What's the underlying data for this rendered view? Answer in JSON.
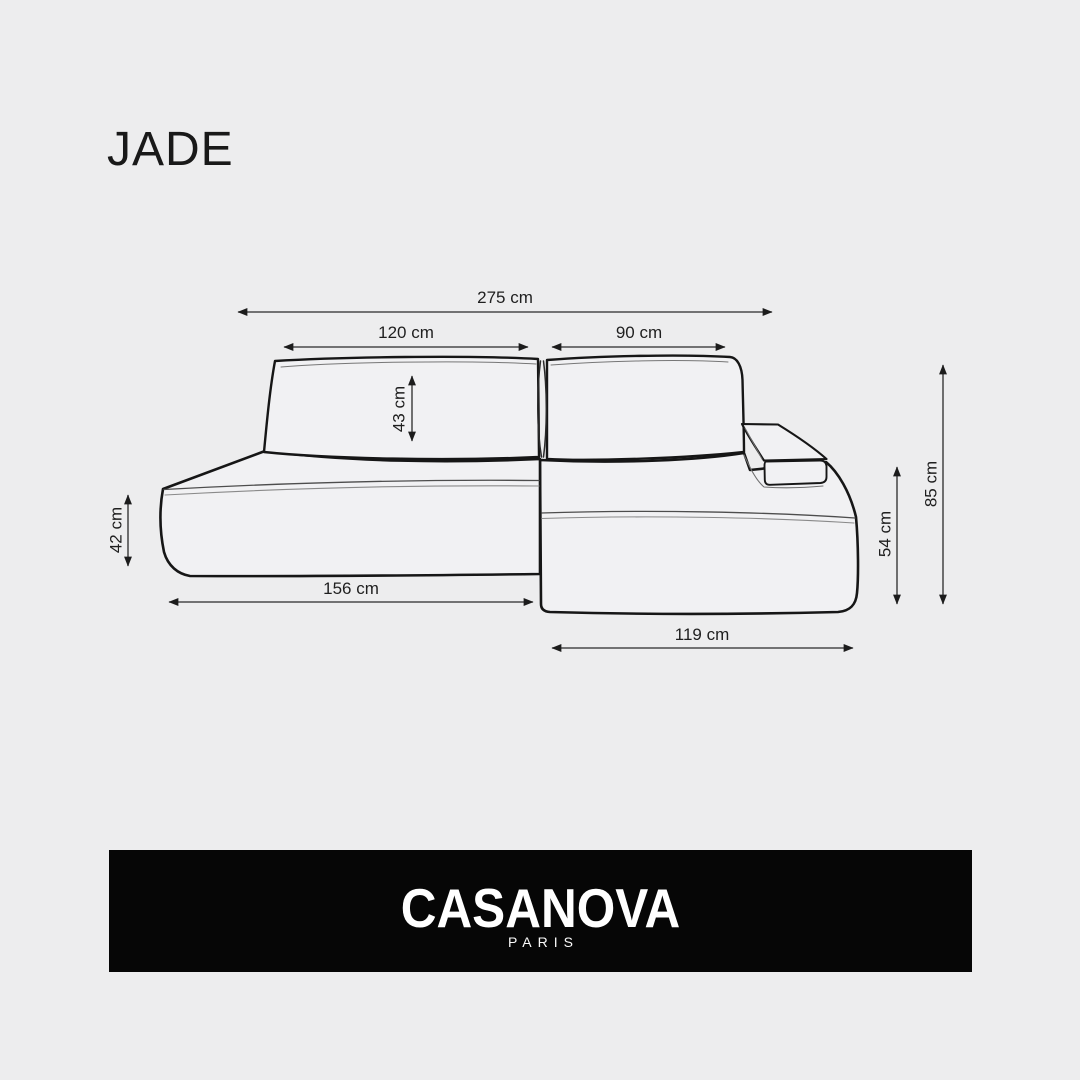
{
  "page": {
    "title": "JADE",
    "background_color": "#ededee"
  },
  "diagram": {
    "subject": "sectional sofa with chaise, technical line drawing, front-right perspective",
    "unit": "cm",
    "dims": {
      "total_width": {
        "label": "275 cm",
        "value": 275,
        "unit": "cm",
        "orientation": "horizontal"
      },
      "back_left_width": {
        "label": "120 cm",
        "value": 120,
        "unit": "cm",
        "orientation": "horizontal"
      },
      "back_right_width": {
        "label": "90 cm",
        "value": 90,
        "unit": "cm",
        "orientation": "horizontal"
      },
      "cushion_height": {
        "label": "43 cm",
        "value": 43,
        "unit": "cm",
        "orientation": "vertical"
      },
      "seat_height": {
        "label": "42 cm",
        "value": 42,
        "unit": "cm",
        "orientation": "vertical"
      },
      "left_section_length": {
        "label": "156 cm",
        "value": 156,
        "unit": "cm",
        "orientation": "horizontal"
      },
      "chaise_length": {
        "label": "119 cm",
        "value": 119,
        "unit": "cm",
        "orientation": "horizontal"
      },
      "chaise_height": {
        "label": "54 cm",
        "value": 54,
        "unit": "cm",
        "orientation": "vertical"
      },
      "total_height": {
        "label": "85 cm",
        "value": 85,
        "unit": "cm",
        "orientation": "vertical"
      }
    }
  },
  "brand": {
    "name": "CASANOVA",
    "city": "PARIS",
    "banner_background": "#060606",
    "text_color": "#ffffff"
  }
}
